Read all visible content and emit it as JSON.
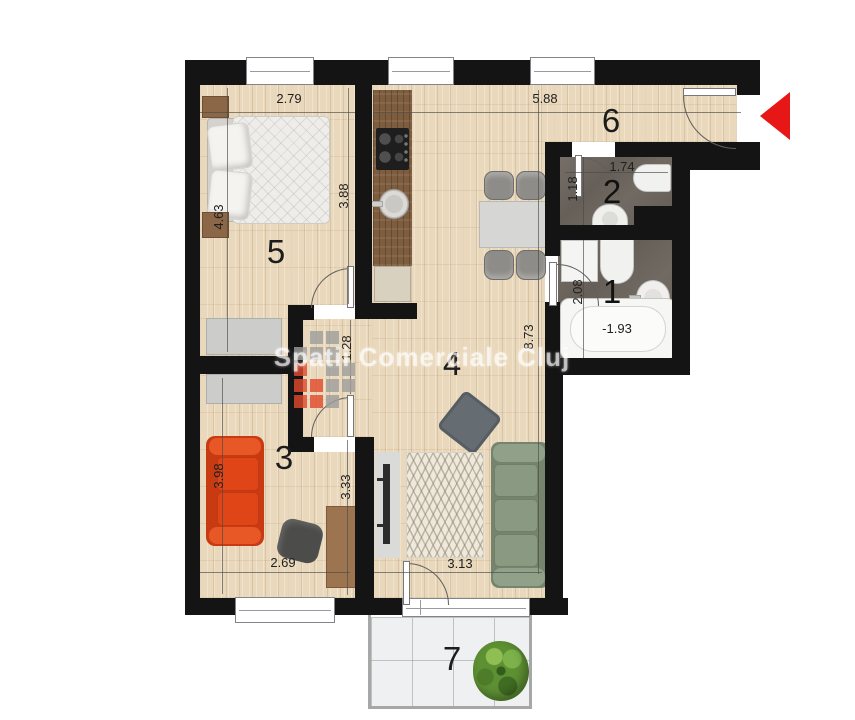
{
  "watermark": {
    "text": "Spatii Comerciale Cluj"
  },
  "rooms": {
    "r1": "1",
    "r2": "2",
    "r3": "3",
    "r4": "4",
    "r5": "5",
    "r6": "6",
    "r7": "7"
  },
  "dims": {
    "w279": "2.79",
    "w588": "5.88",
    "h388": "3.88",
    "h463": "4.63",
    "w174": "1.74",
    "h118": "1.18",
    "h208": "2.08",
    "tub": "-1.93",
    "h873": "8.73",
    "h128": "1.28",
    "h398": "3.98",
    "w269": "2.69",
    "h333": "3.33",
    "w313": "3.13"
  },
  "colors": {
    "wall": "#141414",
    "wood_floor": "#e9d8bb",
    "kitchen_counter": "#7e5d3e",
    "bathroom_tile": "#6f6862",
    "balcony_tile": "#eef0f1",
    "sofa_red": "#e04518",
    "sofa_green": "#87957e",
    "arrow_red": "#e81717"
  }
}
